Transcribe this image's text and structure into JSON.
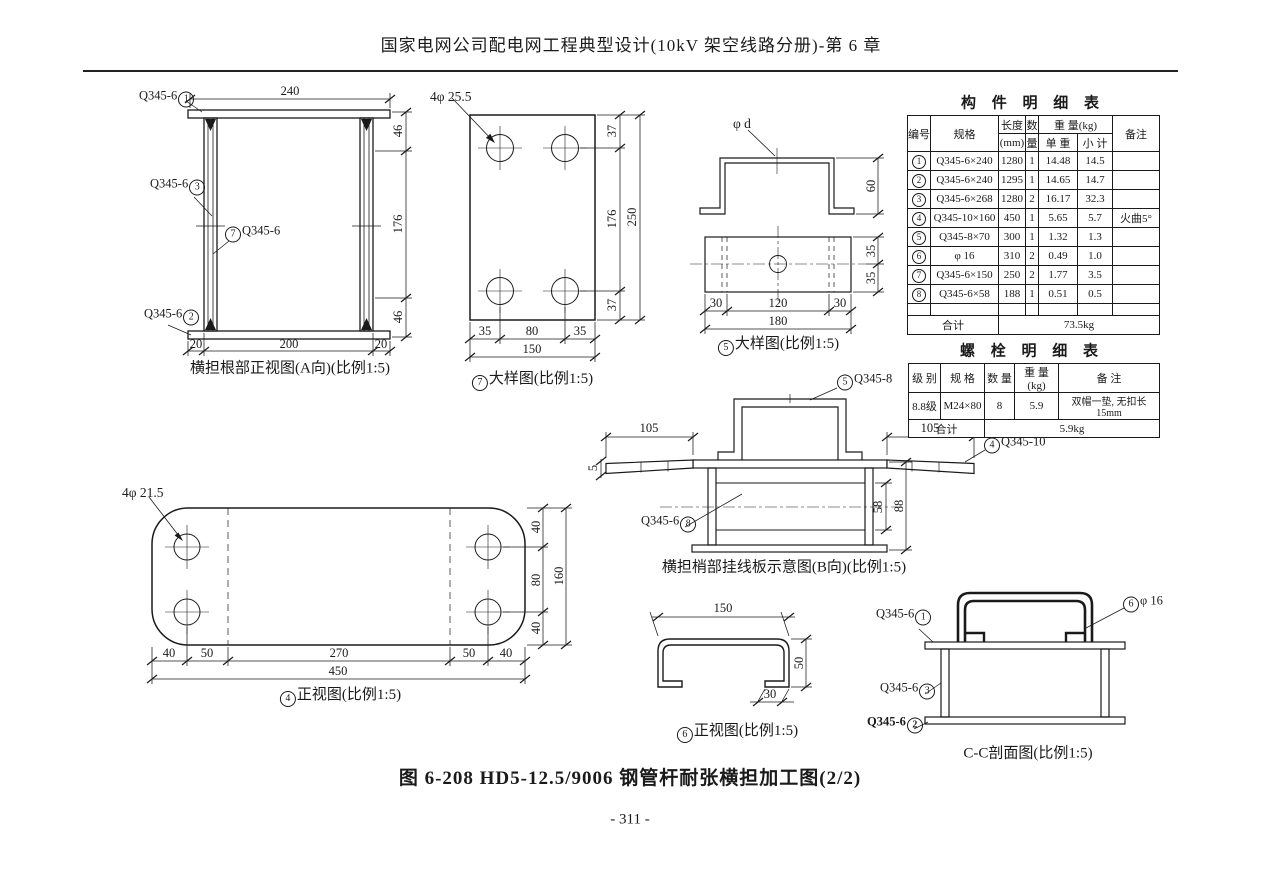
{
  "header": {
    "title": "国家电网公司配电网工程典型设计(10kV 架空线路分册)-第 6 章"
  },
  "footer": {
    "figure_caption": "图 6-208  HD5-12.5/9006 钢管杆耐张横担加工图(2/2)",
    "page_number": "- 311 -"
  },
  "drawing_a": {
    "caption": "横担根部正视图(A向)(比例1:5)",
    "label_1": "Q345-6",
    "num_1": "1",
    "label_3": "Q345-6",
    "num_3": "3",
    "label_7": "Q345-6",
    "num_7": "7",
    "label_2": "Q345-6",
    "num_2": "2",
    "dim_top": "240",
    "dim_r1": "46",
    "dim_r2": "176",
    "dim_r3": "46",
    "dim_b1": "20",
    "dim_b2": "200",
    "dim_b3": "20"
  },
  "drawing_7": {
    "caption_num": "7",
    "caption": "大样图(比例1:5)",
    "hole_label": "4φ 25.5",
    "dim_r1": "37",
    "dim_r2": "176",
    "dim_r3": "37",
    "dim_r_total": "250",
    "dim_b1": "35",
    "dim_b2": "80",
    "dim_b3": "35",
    "dim_b_total": "150"
  },
  "drawing_5": {
    "caption_num": "5",
    "caption": "大样图(比例1:5)",
    "hole_label": "φ d",
    "dim_height": "60",
    "dim_r1": "35",
    "dim_r2": "35",
    "dim_b1": "30",
    "dim_b2": "120",
    "dim_b3": "30",
    "dim_b_total": "180"
  },
  "component_table": {
    "title": "构 件 明 细 表",
    "h_num": "编号",
    "h_spec": "规格",
    "h_len1": "长度",
    "h_len2": "(mm)",
    "h_qty1": "数",
    "h_qty2": "量",
    "h_weight": "重  量(kg)",
    "h_unit": "单  重",
    "h_sub": "小  计",
    "h_note": "备注",
    "rows": [
      {
        "num": "1",
        "spec": "Q345-6×240",
        "len": "1280",
        "qty": "1",
        "unit": "14.48",
        "sub": "14.5",
        "note": ""
      },
      {
        "num": "2",
        "spec": "Q345-6×240",
        "len": "1295",
        "qty": "1",
        "unit": "14.65",
        "sub": "14.7",
        "note": ""
      },
      {
        "num": "3",
        "spec": "Q345-6×268",
        "len": "1280",
        "qty": "2",
        "unit": "16.17",
        "sub": "32.3",
        "note": ""
      },
      {
        "num": "4",
        "spec": "Q345-10×160",
        "len": "450",
        "qty": "1",
        "unit": "5.65",
        "sub": "5.7",
        "note": "火曲5°"
      },
      {
        "num": "5",
        "spec": "Q345-8×70",
        "len": "300",
        "qty": "1",
        "unit": "1.32",
        "sub": "1.3",
        "note": ""
      },
      {
        "num": "6",
        "spec": "φ 16",
        "len": "310",
        "qty": "2",
        "unit": "0.49",
        "sub": "1.0",
        "note": ""
      },
      {
        "num": "7",
        "spec": "Q345-6×150",
        "len": "250",
        "qty": "2",
        "unit": "1.77",
        "sub": "3.5",
        "note": ""
      },
      {
        "num": "8",
        "spec": "Q345-6×58",
        "len": "188",
        "qty": "1",
        "unit": "0.51",
        "sub": "0.5",
        "note": ""
      }
    ],
    "total_label": "合计",
    "total_value": "73.5kg"
  },
  "bolt_table": {
    "title": "螺 栓 明 细 表",
    "h_grade": "级 别",
    "h_spec": "规 格",
    "h_qty": "数 量",
    "h_weight": "重 量(kg)",
    "h_note": "备  注",
    "grade": "8.8级",
    "spec": "M24×80",
    "qty": "8",
    "weight": "5.9",
    "note": "双帽一垫, 无扣长15mm",
    "total_label": "合计",
    "total_value": "5.9kg"
  },
  "drawing_b": {
    "caption": "横担梢部挂线板示意图(B向)(比例1:5)",
    "label_5": "Q345-8",
    "num_5": "5",
    "label_4": "Q345-10",
    "num_4": "4",
    "label_8": "Q345-6",
    "num_8": "8",
    "dim_l": "105",
    "dim_r": "105",
    "dim_5": "5",
    "dim_58": "58",
    "dim_88": "88"
  },
  "drawing_4": {
    "caption_num": "4",
    "caption": "正视图(比例1:5)",
    "hole_label": "4φ 21.5",
    "dim_r1": "40",
    "dim_r2": "80",
    "dim_r3": "40",
    "dim_r_total": "160",
    "dim_b1": "40",
    "dim_b2": "50",
    "dim_b3": "270",
    "dim_b4": "50",
    "dim_b5": "40",
    "dim_b_total": "450"
  },
  "drawing_6": {
    "caption_num": "6",
    "caption": "正视图(比例1:5)",
    "dim_top": "150",
    "dim_right": "50",
    "dim_bottom": "30"
  },
  "drawing_cc": {
    "caption": "C-C剖面图(比例1:5)",
    "label_1": "Q345-6",
    "num_1": "1",
    "label_3": "Q345-6",
    "num_3": "3",
    "label_2": "Q345-6",
    "num_2": "2",
    "num_6": "6",
    "label_6": "φ 16"
  }
}
